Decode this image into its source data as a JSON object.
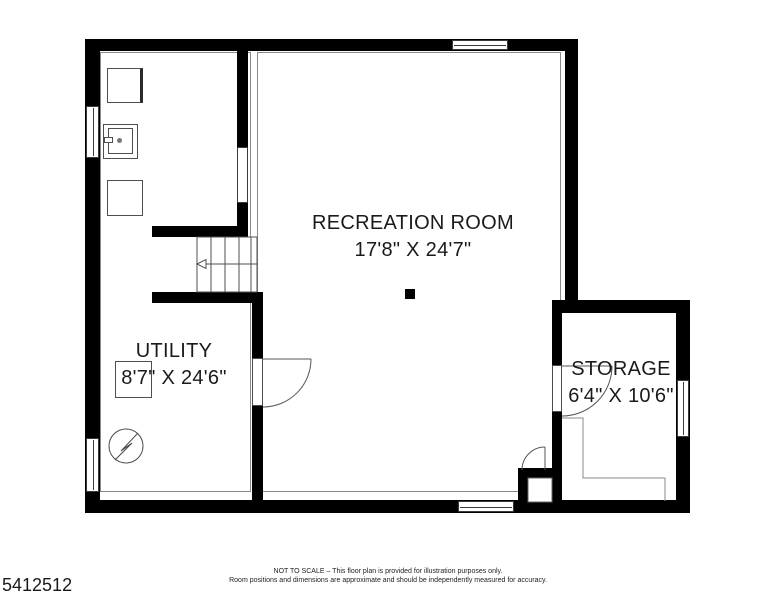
{
  "floor_plan": {
    "rooms": [
      {
        "name": "RECREATION ROOM",
        "dimensions": "17'8\" X 24'7\""
      },
      {
        "name": "UTILITY",
        "dimensions": "8'7\" X 24'6\""
      },
      {
        "name": "STORAGE",
        "dimensions": "6'4\" X 10'6\""
      }
    ],
    "listing_id": "5412512",
    "disclaimer": {
      "line1": "NOT TO SCALE – This floor plan is provided for illustration purposes only.",
      "line2": "Room positions and dimensions are approximate and should be independently measured for accuracy."
    },
    "symbols": [
      "washer",
      "laundry-sink",
      "dryer",
      "staircase-with-direction-arrow",
      "sump-pump",
      "support-post",
      "door-swing",
      "window"
    ],
    "colors": {
      "walls": "#000000",
      "fixture_lines": "#4f4f4f",
      "boundary_lines": "#8a8a8a",
      "text": "#1a1a1a",
      "background": "#ffffff"
    }
  }
}
